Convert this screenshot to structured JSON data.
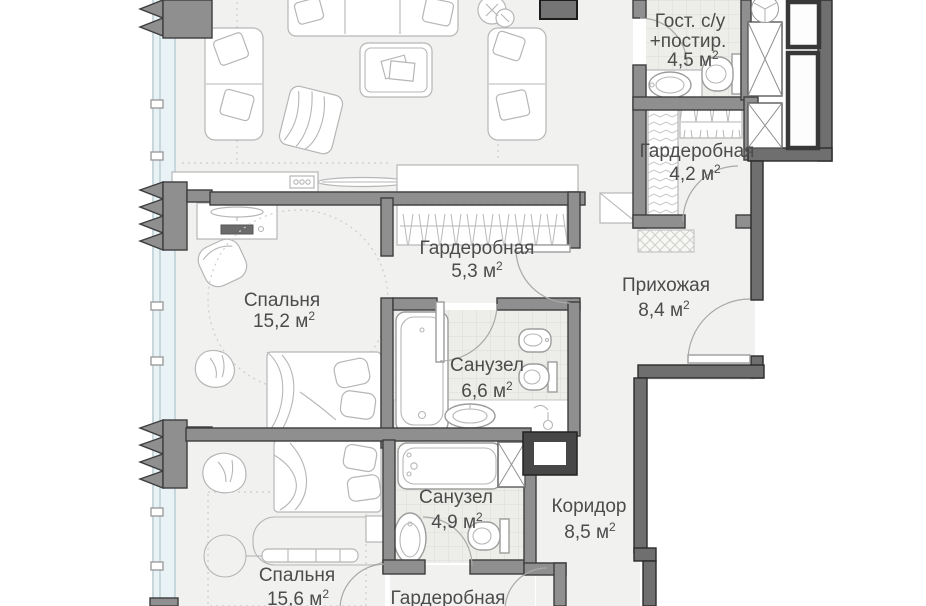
{
  "colors": {
    "background": "#ffffff",
    "floor": "#f1f1f0",
    "tile_floor": "#edede9",
    "wall": "#8f8f8f",
    "outer_wall": "#6f6f6f",
    "window_glazing": "#e9f2f5",
    "label_text": "#4c4c4c",
    "furniture_line": "#b6b6b6"
  },
  "rooms": {
    "guest_wc": {
      "name_line1": "Гост. с/у",
      "name_line2": "+постир.",
      "area": "4,5 м",
      "area_sup": "2"
    },
    "wardrobe_top": {
      "name": "Гардеробная",
      "area": "4,2 м",
      "area_sup": "2"
    },
    "wardrobe_master": {
      "name": "Гардеробная",
      "area": "5,3 м",
      "area_sup": "2"
    },
    "hallway": {
      "name": "Прихожая",
      "area": "8,4 м",
      "area_sup": "2"
    },
    "bedroom_1": {
      "name": "Спальня",
      "area": "15,2 м",
      "area_sup": "2"
    },
    "bathroom_1": {
      "name": "Санузел",
      "area": "6,6 м",
      "area_sup": "2"
    },
    "bathroom_2": {
      "name": "Санузел",
      "area": "4,9 м",
      "area_sup": "2"
    },
    "corridor": {
      "name": "Коридор",
      "area": "8,5 м",
      "area_sup": "2"
    },
    "bedroom_2": {
      "name": "Спальня",
      "area": "15,6 м",
      "area_sup": "2"
    },
    "wardrobe_bottom": {
      "name": "Гардеробная"
    }
  }
}
